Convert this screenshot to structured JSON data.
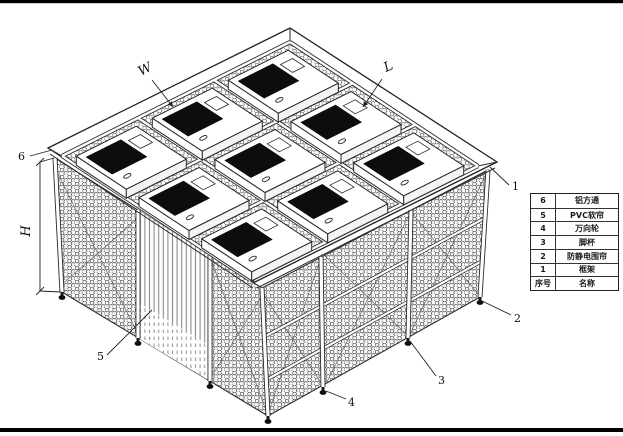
{
  "drawing": {
    "title": "clean-booth-isometric-drawing",
    "dimension_labels": {
      "width": "W",
      "length": "L",
      "height": "H"
    },
    "callouts": {
      "c1": "1",
      "c2": "2",
      "c3": "3",
      "c4": "4",
      "c5": "5",
      "c6": "6"
    },
    "ffu_count": 9,
    "roof_grid": "3x3"
  },
  "parts_table": {
    "header": {
      "no": "序号",
      "name": "名称"
    },
    "rows": [
      {
        "no": "6",
        "name": "铝方通"
      },
      {
        "no": "5",
        "name": "PVC软帘"
      },
      {
        "no": "4",
        "name": "万向轮"
      },
      {
        "no": "3",
        "name": "脚杯"
      },
      {
        "no": "2",
        "name": "防静电围帘"
      },
      {
        "no": "1",
        "name": "框架"
      }
    ]
  },
  "colors": {
    "line": "#2a2a2a",
    "mesh": "#4f4f4f",
    "ffu_filter": "#0d0d0d",
    "curtain_stripe": "#8a8a8a",
    "border_bar": "#000000",
    "background": "#ffffff"
  }
}
